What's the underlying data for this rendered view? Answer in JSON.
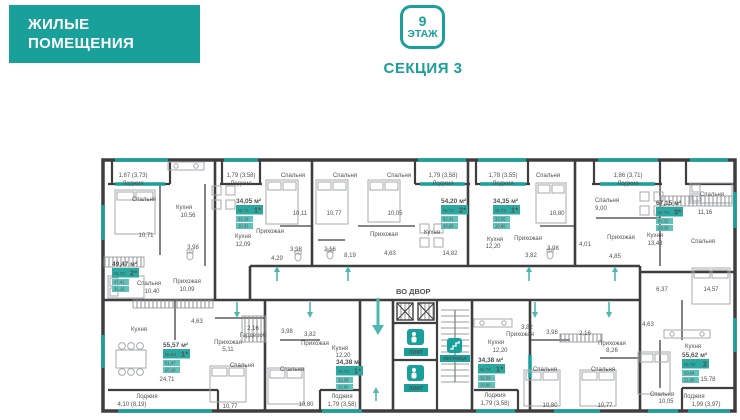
{
  "header": {
    "title_line1": "ЖИЛЫЕ",
    "title_line2": "ПОМЕЩЕНИЯ",
    "floor_number": "9",
    "floor_label": "ЭТАЖ",
    "section": "СЕКЦИЯ 3"
  },
  "colors": {
    "teal": "#1AA09A",
    "badge_sub": "#5FC2BB",
    "wall": "#3E3E40",
    "text": "#515151"
  },
  "plan": {
    "courtyard_label": "ВО ДВОР",
    "lift_label": "ЛИФТ",
    "stairs_label": "ЛЕСТНИЦА",
    "labels": [
      {
        "x": 133,
        "y": 177,
        "t": "1,87 (3,73)"
      },
      {
        "x": 133,
        "y": 185,
        "t": "Лоджия"
      },
      {
        "x": 241,
        "y": 177,
        "t": "1,79 (3,58)"
      },
      {
        "x": 241,
        "y": 185,
        "t": "Лоджия"
      },
      {
        "x": 443,
        "y": 177,
        "t": "1,79 (3,58)"
      },
      {
        "x": 443,
        "y": 185,
        "t": "Лоджия"
      },
      {
        "x": 503,
        "y": 177,
        "t": "1,78 (3,55)"
      },
      {
        "x": 503,
        "y": 185,
        "t": "Лоджия"
      },
      {
        "x": 628,
        "y": 177,
        "t": "1,86 (3,71)"
      },
      {
        "x": 628,
        "y": 185,
        "t": "Лоджия"
      },
      {
        "x": 144,
        "y": 201,
        "t": "Спальня"
      },
      {
        "x": 146,
        "y": 237,
        "t": "10,71"
      },
      {
        "x": 184,
        "y": 209,
        "t": "Кухня"
      },
      {
        "x": 188,
        "y": 217,
        "t": "10,56"
      },
      {
        "x": 293,
        "y": 177,
        "t": "Спальня"
      },
      {
        "x": 300,
        "y": 215,
        "t": "10,11"
      },
      {
        "x": 345,
        "y": 177,
        "t": "Спальня"
      },
      {
        "x": 334,
        "y": 215,
        "t": "10,77"
      },
      {
        "x": 399,
        "y": 177,
        "t": "Спальня"
      },
      {
        "x": 395,
        "y": 215,
        "t": "10,05"
      },
      {
        "x": 548,
        "y": 177,
        "t": "Спальня"
      },
      {
        "x": 557,
        "y": 215,
        "t": "10,80"
      },
      {
        "x": 607,
        "y": 202,
        "t": "Спальня"
      },
      {
        "x": 601,
        "y": 210,
        "t": "9,00"
      },
      {
        "x": 712,
        "y": 196,
        "t": "Спальня"
      },
      {
        "x": 705,
        "y": 214,
        "t": "11,16"
      },
      {
        "x": 703,
        "y": 243,
        "t": "Спальня"
      },
      {
        "x": 243,
        "y": 238,
        "t": "Кухня"
      },
      {
        "x": 243,
        "y": 246,
        "t": "12,09"
      },
      {
        "x": 432,
        "y": 234,
        "t": "Кухня"
      },
      {
        "x": 450,
        "y": 255,
        "t": "14,82"
      },
      {
        "x": 495,
        "y": 241,
        "t": "Кухня"
      },
      {
        "x": 493,
        "y": 248,
        "t": "12,20"
      },
      {
        "x": 655,
        "y": 237,
        "t": "Кухня"
      },
      {
        "x": 655,
        "y": 245,
        "t": "13,48"
      },
      {
        "x": 270,
        "y": 233,
        "t": "Прихожая"
      },
      {
        "x": 384,
        "y": 236,
        "t": "Прихожая"
      },
      {
        "x": 528,
        "y": 240,
        "t": "Прихожая"
      },
      {
        "x": 621,
        "y": 239,
        "t": "Прихожая"
      },
      {
        "x": 193,
        "y": 249,
        "t": "3,98"
      },
      {
        "x": 296,
        "y": 251,
        "t": "3,98"
      },
      {
        "x": 330,
        "y": 251,
        "t": "2,16"
      },
      {
        "x": 350,
        "y": 257,
        "t": "8,19"
      },
      {
        "x": 277,
        "y": 260,
        "t": "4,29"
      },
      {
        "x": 390,
        "y": 255,
        "t": "4,63"
      },
      {
        "x": 553,
        "y": 250,
        "t": "3,98"
      },
      {
        "x": 531,
        "y": 257,
        "t": "3,82"
      },
      {
        "x": 585,
        "y": 246,
        "t": "4,01"
      },
      {
        "x": 615,
        "y": 258,
        "t": "4,85"
      },
      {
        "x": 662,
        "y": 291,
        "t": "6,37"
      },
      {
        "x": 711,
        "y": 291,
        "t": "14,57"
      },
      {
        "x": 149,
        "y": 285,
        "t": "Спальня"
      },
      {
        "x": 152,
        "y": 293,
        "t": "10,40"
      },
      {
        "x": 187,
        "y": 283,
        "t": "Прихожая"
      },
      {
        "x": 187,
        "y": 291,
        "t": "10,09"
      },
      {
        "x": 197,
        "y": 323,
        "t": "4,63"
      },
      {
        "x": 139,
        "y": 331,
        "t": "Кухня"
      },
      {
        "x": 167,
        "y": 381,
        "t": "24,71"
      },
      {
        "x": 147,
        "y": 398,
        "t": "Лоджия"
      },
      {
        "x": 132,
        "y": 406,
        "t": "4,10 (8,19)"
      },
      {
        "x": 228,
        "y": 344,
        "t": "Прихожая"
      },
      {
        "x": 228,
        "y": 351,
        "t": "5,11"
      },
      {
        "x": 242,
        "y": 367,
        "t": "Спальня"
      },
      {
        "x": 230,
        "y": 408,
        "t": "10,77"
      },
      {
        "x": 253,
        "y": 330,
        "t": "2,16"
      },
      {
        "x": 253,
        "y": 337,
        "t": "Гардероб"
      },
      {
        "x": 287,
        "y": 333,
        "t": "3,98"
      },
      {
        "x": 310,
        "y": 336,
        "t": "3,82"
      },
      {
        "x": 315,
        "y": 345,
        "t": "Прихожая"
      },
      {
        "x": 340,
        "y": 350,
        "t": "Кухня"
      },
      {
        "x": 343,
        "y": 357,
        "t": "12,20"
      },
      {
        "x": 292,
        "y": 371,
        "t": "Спальня"
      },
      {
        "x": 306,
        "y": 406,
        "t": "10,80"
      },
      {
        "x": 342,
        "y": 398,
        "t": "Лоджия"
      },
      {
        "x": 342,
        "y": 406,
        "t": "1,79 (3,58)"
      },
      {
        "x": 496,
        "y": 344,
        "t": "Кухня"
      },
      {
        "x": 500,
        "y": 352,
        "t": "12,20"
      },
      {
        "x": 520,
        "y": 336,
        "t": "Прихожая"
      },
      {
        "x": 527,
        "y": 329,
        "t": "3,82"
      },
      {
        "x": 552,
        "y": 334,
        "t": "3,98"
      },
      {
        "x": 585,
        "y": 335,
        "t": "2,16"
      },
      {
        "x": 612,
        "y": 345,
        "t": "Прихожая"
      },
      {
        "x": 612,
        "y": 352,
        "t": "8,26"
      },
      {
        "x": 545,
        "y": 371,
        "t": "Спальня"
      },
      {
        "x": 550,
        "y": 407,
        "t": "10,80"
      },
      {
        "x": 603,
        "y": 371,
        "t": "Спальня"
      },
      {
        "x": 605,
        "y": 407,
        "t": "10,77"
      },
      {
        "x": 495,
        "y": 397,
        "t": "Лоджия"
      },
      {
        "x": 495,
        "y": 405,
        "t": "1,79 (3,58)"
      },
      {
        "x": 648,
        "y": 326,
        "t": "4,63"
      },
      {
        "x": 693,
        "y": 348,
        "t": "Кухня"
      },
      {
        "x": 708,
        "y": 381,
        "t": "15,78"
      },
      {
        "x": 662,
        "y": 396,
        "t": "Спальня"
      },
      {
        "x": 666,
        "y": 403,
        "t": "10,05"
      },
      {
        "x": 694,
        "y": 398,
        "t": "Лоджия"
      },
      {
        "x": 706,
        "y": 406,
        "t": "1,99 (3,97)"
      }
    ],
    "badges": [
      {
        "x": 112,
        "y": 260,
        "area": "49,47 м²",
        "num": "№ 70",
        "rooms": "2*",
        "sub1": "47,41",
        "sub2": "31,15"
      },
      {
        "x": 236,
        "y": 197,
        "area": "34,05 м²",
        "num": "№ 71",
        "rooms": "1*",
        "sub1": "32,18",
        "sub2": "10,31"
      },
      {
        "x": 441,
        "y": 197,
        "area": "54,20 м²",
        "num": "№ 72",
        "rooms": "2*",
        "sub1": "52,41",
        "sub2": "20,86"
      },
      {
        "x": 493,
        "y": 197,
        "area": "34,35 м²",
        "num": "№ 73",
        "rooms": "1*",
        "sub1": "32,56",
        "sub2": "10,80"
      },
      {
        "x": 656,
        "y": 199,
        "area": "67,15 м²",
        "num": "№ 74",
        "rooms": "3*",
        "sub1": "65,32",
        "sub2": "28,33"
      },
      {
        "x": 163,
        "y": 341,
        "area": "55,57 м²",
        "num": "№ 69",
        "rooms": "1*",
        "sub1": "51,47",
        "sub2": "20,16"
      },
      {
        "x": 336,
        "y": 358,
        "area": "34,38 м²",
        "num": "№ 75",
        "rooms": "1*",
        "sub1": "32,59",
        "sub2": "10,80"
      },
      {
        "x": 478,
        "y": 356,
        "area": "34,38 м²",
        "num": "№ 76",
        "rooms": "1*",
        "sub1": "32,59",
        "sub2": "10,80"
      },
      {
        "x": 682,
        "y": 351,
        "area": "55,62 м²",
        "num": "№ 78",
        "rooms": "2",
        "sub1": "53,64",
        "sub2": "21,85"
      }
    ]
  }
}
